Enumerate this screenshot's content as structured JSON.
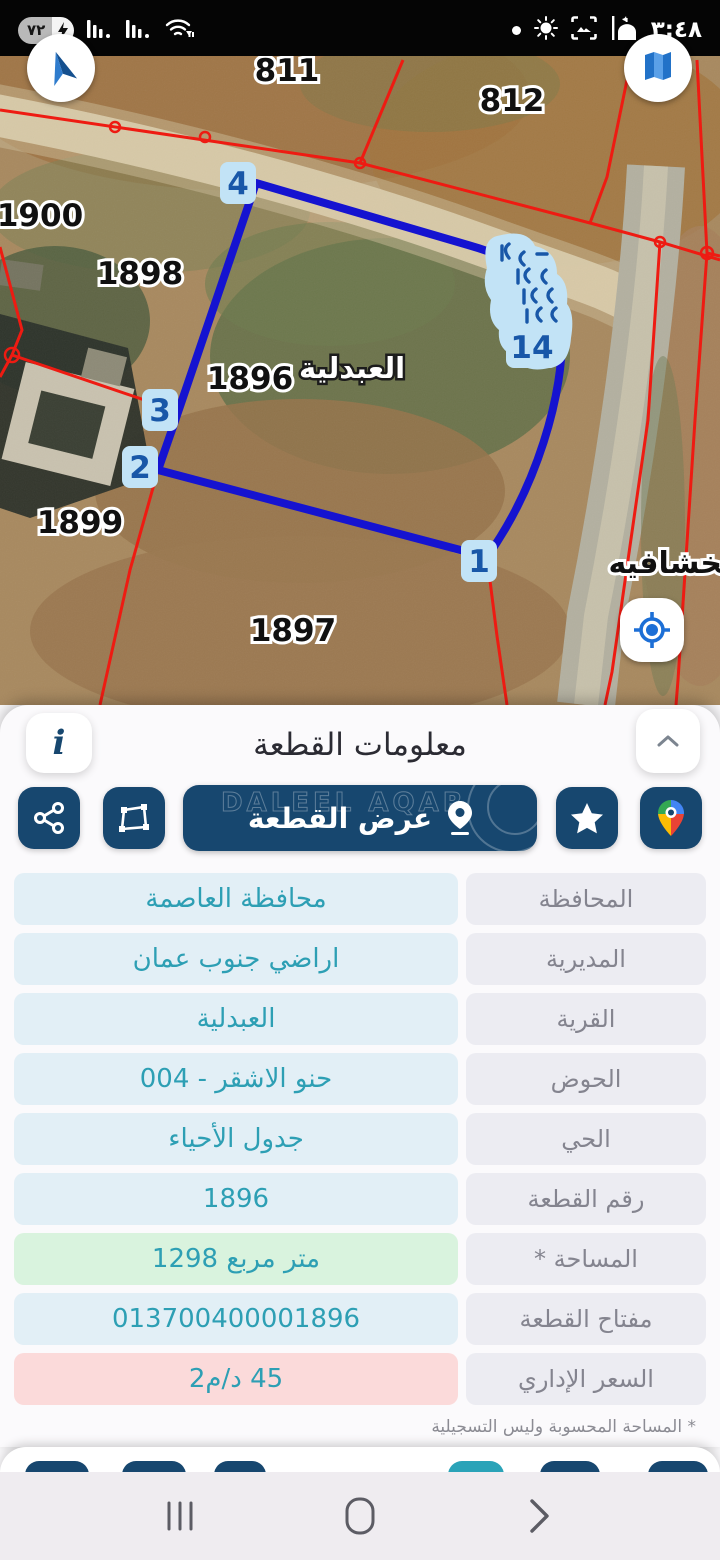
{
  "status_bar": {
    "time": "٣:٤٨",
    "battery_percent": "٧٢",
    "bolt": "⚡",
    "icons_left": [
      "battery-charging",
      "signal-sim1",
      "signal-sim2",
      "wifi-traffic"
    ],
    "icons_right": [
      "dot",
      "brightness",
      "screenshot",
      "mosque"
    ]
  },
  "map": {
    "selected_parcel": "1896",
    "region_label": {
      "text": "العبدلية",
      "x": 352,
      "y": 322
    },
    "district_label": {
      "text": "الخشافيه",
      "x": 676,
      "y": 517
    },
    "parcel_labels": [
      {
        "text": "811",
        "x": 287,
        "y": 25
      },
      {
        "text": "812",
        "x": 512,
        "y": 55
      },
      {
        "text": "1900",
        "x": 40,
        "y": 170
      },
      {
        "text": "1898",
        "x": 140,
        "y": 228
      },
      {
        "text": "1896",
        "x": 250,
        "y": 333
      },
      {
        "text": "1899",
        "x": 80,
        "y": 477
      },
      {
        "text": "1897",
        "x": 293,
        "y": 585
      }
    ],
    "vertex_labels": [
      {
        "text": "4",
        "x": 238,
        "y": 127,
        "w": 36
      },
      {
        "text": "3",
        "x": 160,
        "y": 354,
        "w": 36
      },
      {
        "text": "2",
        "x": 140,
        "y": 411,
        "w": 36
      },
      {
        "text": "1",
        "x": 479,
        "y": 505,
        "w": 36
      },
      {
        "text": "14",
        "x": 532,
        "y": 291,
        "w": 52
      }
    ],
    "colors": {
      "boundary": "#1513d0",
      "cadastral": "#ee1b12",
      "vertex_chip": "#c2e3f6",
      "vertex_text": "#1857a8"
    }
  },
  "sheet": {
    "title": "معلومات القطعة",
    "info_button_glyph": "i",
    "view_button": {
      "label": "عرض القطعة",
      "watermark": "DALEEL AQAR"
    },
    "rows": [
      {
        "label": "المحافظة",
        "value": "محافظة العاصمة",
        "type": "normal"
      },
      {
        "label": "المديرية",
        "value": "اراضي جنوب عمان",
        "type": "normal"
      },
      {
        "label": "القرية",
        "value": "العبدلية",
        "type": "normal"
      },
      {
        "label": "الحوض",
        "value": "حنو الاشقر - 004",
        "type": "normal"
      },
      {
        "label": "الحي",
        "value": "جدول الأحياء",
        "type": "normal"
      },
      {
        "label": "رقم القطعة",
        "value": "1896",
        "type": "normal"
      },
      {
        "label": "المساحة *",
        "value": "متر مربع  1298",
        "type": "area"
      },
      {
        "label": "مفتاح القطعة",
        "value": "013700400001896",
        "type": "normal"
      },
      {
        "label": "السعر الإداري",
        "value": "45 د/م2",
        "type": "price"
      }
    ],
    "footnote": "* المساحة المحسوبة وليس التسجيلية",
    "accent_navy": "#17476f",
    "accent_teal": "#2d9fb4"
  },
  "nav_bar": {
    "icons": [
      "recents",
      "home",
      "back"
    ]
  }
}
